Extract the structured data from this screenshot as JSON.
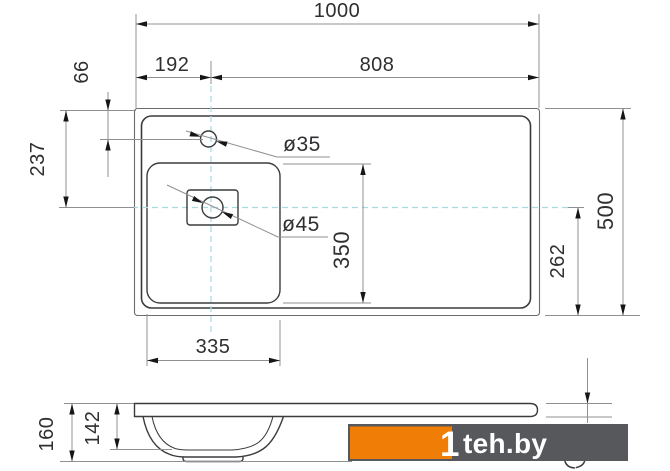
{
  "top_view": {
    "dim_total_width": "1000",
    "dim_faucet_offset_left": "192",
    "dim_faucet_to_right_edge": "808",
    "dim_faucet_offset_top": "66",
    "dim_drain_offset_top": "237",
    "label_faucet_hole": "ø35",
    "label_drain_hole": "ø45",
    "dim_basin_length": "350",
    "dim_drain_axis_to_bottom": "262",
    "dim_total_depth": "500",
    "dim_basin_width": "335"
  },
  "side_view": {
    "dim_total_height": "160",
    "dim_bowl_height": "142"
  },
  "watermark": {
    "logo_digit": "1",
    "site": "teh.by"
  },
  "colors": {
    "outline": "#3a3b3d",
    "outline_thin": "#6b6b6d",
    "dim_line": "#8f9094",
    "arrow": "#161616",
    "centerline": "#a9dce1",
    "text": "#2e2f31",
    "watermark_orange": "#f07e06",
    "watermark_dark": "#57585b"
  }
}
